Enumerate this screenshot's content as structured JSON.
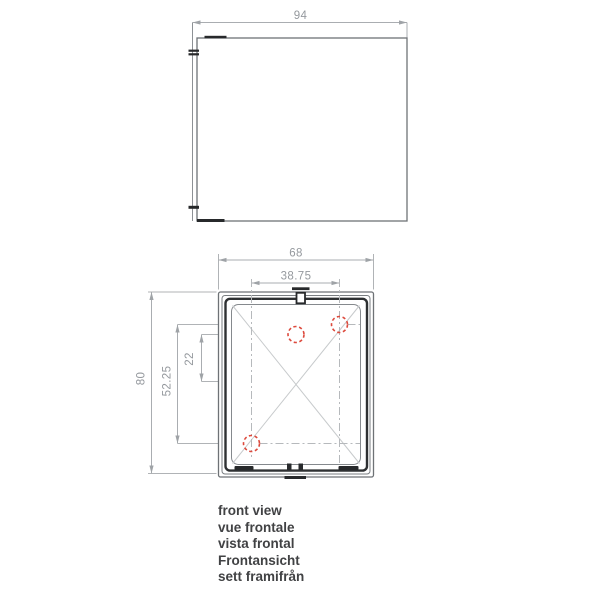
{
  "drawing": {
    "side_view": {
      "dim_depth": "94"
    },
    "front_view": {
      "dim_width": "68",
      "dim_hole_span_x": "38.75",
      "dim_height": "80",
      "dim_hole_span_y": "52.25",
      "dim_hole_offset": "22",
      "mounting_hole_count": 3
    },
    "captions": [
      "front view",
      "vue frontale",
      "vista frontal",
      "Frontansicht",
      "sett framifrån"
    ],
    "colors": {
      "body_line": "#6e7276",
      "dark_detail": "#27292b",
      "dimension_line": "#aaadb1",
      "dimension_text": "#95999e",
      "centerline": "#b6b9bc",
      "diagonal": "#c7cacc",
      "hole_marker_red": "#dd4a3d",
      "caption_text": "#414244"
    }
  }
}
